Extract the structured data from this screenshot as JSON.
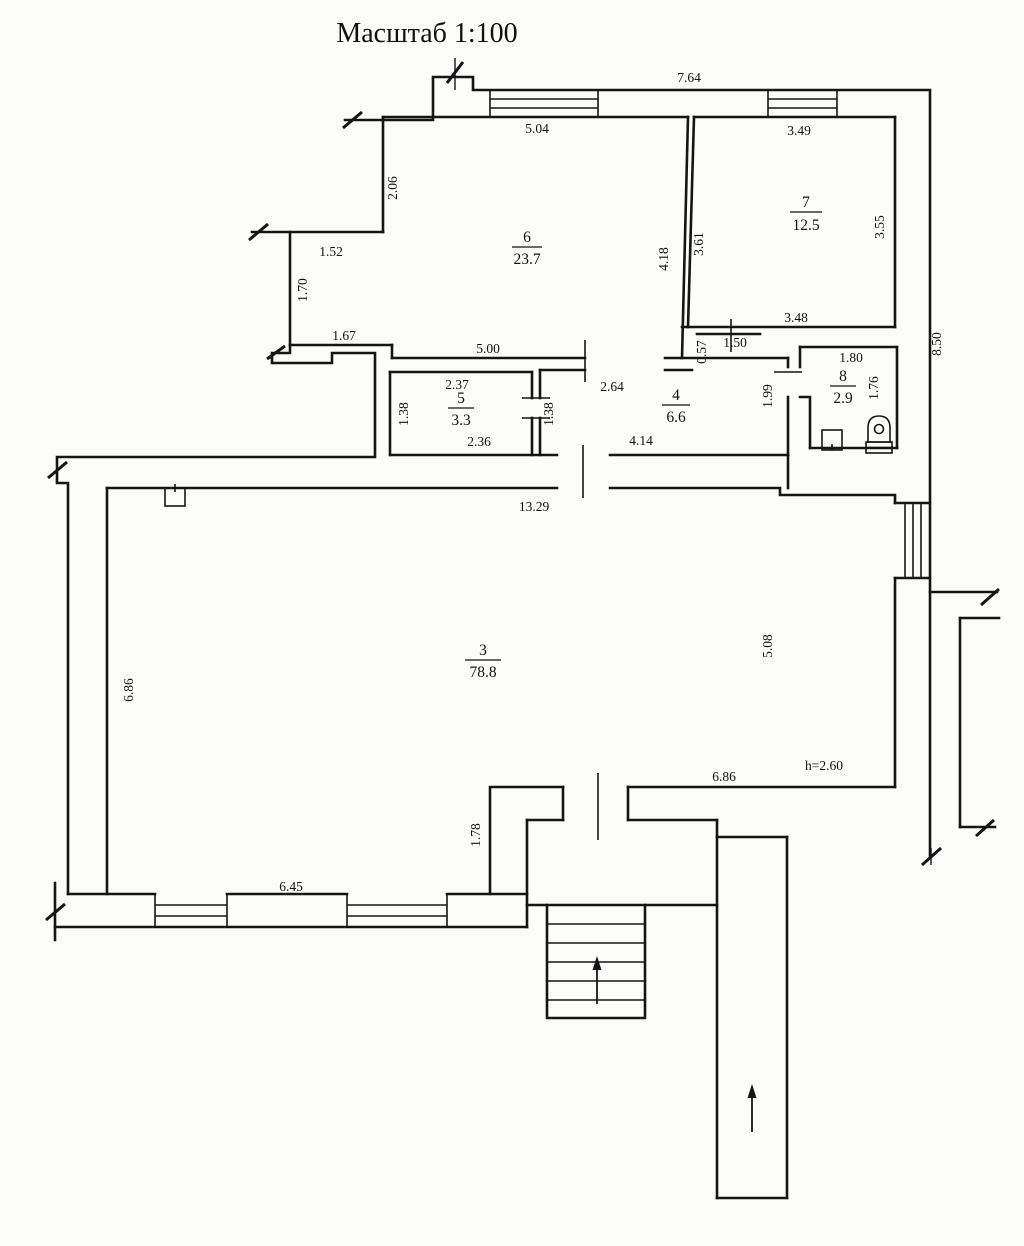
{
  "title": "Масштаб 1:100",
  "rooms": {
    "r3": {
      "number": "3",
      "area": "78.8"
    },
    "r4": {
      "number": "4",
      "area": "6.6"
    },
    "r5": {
      "number": "5",
      "area": "3.3"
    },
    "r6": {
      "number": "6",
      "area": "23.7"
    },
    "r7": {
      "number": "7",
      "area": "12.5"
    },
    "r8": {
      "number": "8",
      "area": "2.9"
    }
  },
  "dimensions": {
    "outer_top": "7.64",
    "room6_top": "5.04",
    "room6_left": "2.06",
    "notch_top": "1.52",
    "notch_left": "1.70",
    "notch_bottom": "1.67",
    "room6_bottom": "5.00",
    "room6_right": "4.18",
    "room7_top": "3.49",
    "room7_left": "3.61",
    "room7_right": "3.55",
    "room7_bottom": "3.48",
    "outer_right": "8.50",
    "lobby_width": "1.50",
    "lobby_depth": "0.57",
    "room8_top": "1.80",
    "room8_right": "1.76",
    "room4_right": "1.99",
    "room4_top": "2.64",
    "room4_bottom": "4.14",
    "room4_left": "1.38",
    "room5_top": "2.37",
    "room5_left": "1.38",
    "room5_bottom": "2.36",
    "room3_top": "13.29",
    "room3_left": "6.86",
    "room3_right": "5.08",
    "room3_bottom_right": "6.86",
    "room3_bottom": "6.45",
    "step_right": "1.78",
    "ceiling_height": "h=2.60"
  }
}
